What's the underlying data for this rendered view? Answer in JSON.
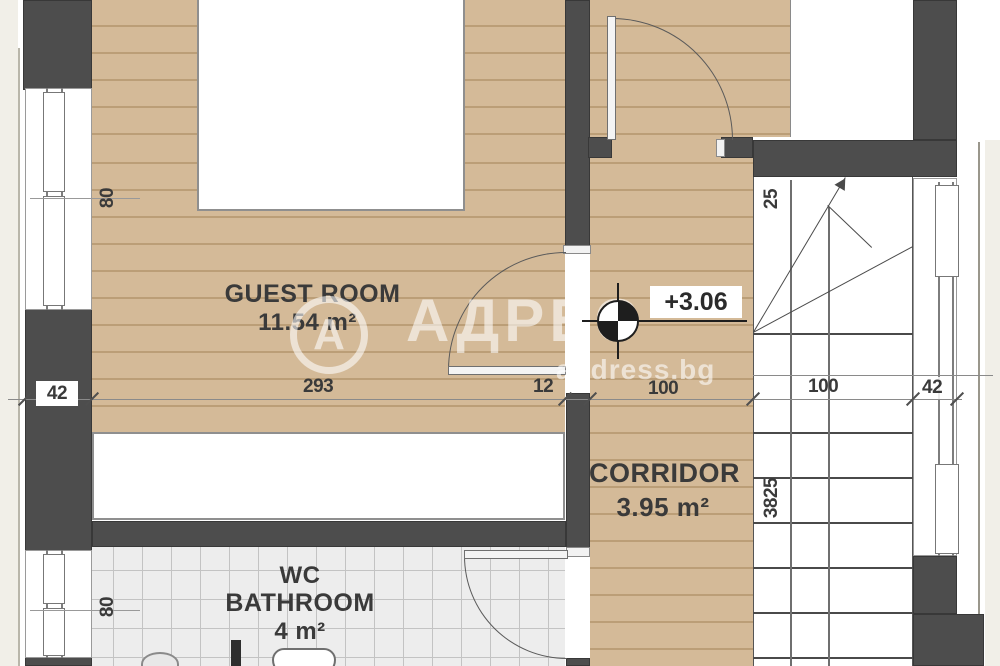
{
  "watermark": {
    "logo_letter": "А",
    "brand": "АДРЕС",
    "site": "address.bg"
  },
  "rooms": {
    "guest": {
      "name": "GUEST ROOM",
      "area": "11.54 m²"
    },
    "corridor": {
      "name": "CORRIDOR",
      "area": "3.95 m²"
    },
    "bathroom": {
      "line1": "WC",
      "line2": "BATHROOM",
      "area": "4 m²"
    }
  },
  "level_mark": "+3.06",
  "dims": {
    "left_wall": "42",
    "guest_width": "293",
    "partition": "12",
    "corridor_width": "100",
    "stair_width": "100",
    "right_wall": "42",
    "window_top": "80",
    "window_bottom": "80",
    "tread": "25",
    "stair_run": "3825"
  },
  "colors": {
    "wood": "#d4ba98",
    "wall": "#4d4d4d",
    "tile": "#ededed",
    "watermark": "#ffffff"
  }
}
